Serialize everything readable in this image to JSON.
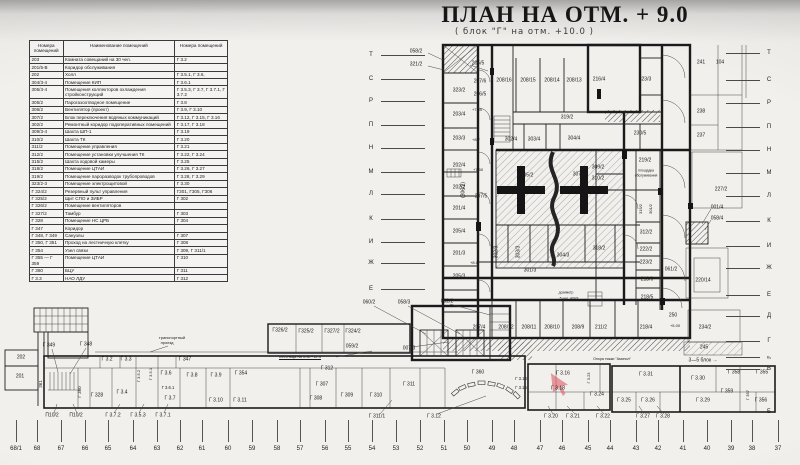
{
  "title": "ПЛАН НА ОТМ. + 9.0",
  "subtitle": "( блок \"Г\"  на  отм.  +10.0 )",
  "colors": {
    "ink": "#1c1c1c",
    "paper": "#f0efec",
    "highlight": "#e0565f"
  },
  "legend": {
    "headers": [
      "Номера помещений",
      "Наименование помещений",
      "Номера помещений"
    ],
    "rows": [
      [
        "203",
        "Комната совещаний на 30 чел.",
        "Г 3.2"
      ],
      [
        "201/5-В",
        "Коридор обслуживания",
        ""
      ],
      [
        "202",
        "Холл",
        "Г 3.5.1,  Г 3.6,"
      ],
      [
        "304/3-4",
        "Помещение КИП",
        "Г 3.6.1"
      ],
      [
        "305/3-4",
        "Помещения коллекторов охлаждения стройконструкций",
        "Г 3.5.3,  Г 3.7, Г 3.7.1,  Г 3.7.2"
      ],
      [
        "305/2",
        "Парогазоотводное помещение",
        "Г 3.8"
      ],
      [
        "306/2",
        "Вентилятор (проект)",
        "Г 3.9,  Г 3.10"
      ],
      [
        "307/2",
        "Блок переключения водяных коммуникаций",
        "Г 3.12,  Г 3.15, Г 3.16"
      ],
      [
        "302/2",
        "Ремонтный коридор подоперативных помещений",
        "Г 3.17, Г 3.18"
      ],
      [
        "309/3-4",
        "Шахта ШП-1",
        "Г 3.19"
      ],
      [
        "310/2",
        "Шахта ТК",
        "Г 3.20"
      ],
      [
        "311/2",
        "Помещение управления",
        "Г 3.21"
      ],
      [
        "312/2",
        "Помещение установки улучшения ТК",
        "Г 3.22, Г 3.24"
      ],
      [
        "315/2",
        "Шахта ходовой камеры",
        "Г 3.25"
      ],
      [
        "318/2",
        "Помещение ЦТАИ",
        "Г 3.26,  Г 3.27"
      ],
      [
        "319/2",
        "Помещение пароразводок трубопроводов",
        "Г 3.28, Г 3.29"
      ],
      [
        "323/2-3",
        "Помещение электрощитовой",
        "Г 3.30"
      ],
      [
        "Г 324/2",
        "Резервный пульт управления",
        "Г301, Г305, Г306"
      ],
      [
        "Г 325/2",
        "Щит СПО и ЗИБР",
        "Г 302"
      ],
      [
        "Г 326/2",
        "Помещение вентиляторов",
        ""
      ],
      [
        "Г 327/2",
        "Тамбур",
        "Г 303"
      ],
      [
        "Г 328",
        "Помещение НС ЦРБ",
        "Г 304"
      ],
      [
        "Г 347",
        "Коридор",
        ""
      ],
      [
        "Г 348, Г 349",
        "Санузлы",
        "Г 307"
      ],
      [
        "Г 350, Г 351",
        "Проход на лестничную клетку",
        "Г 308"
      ],
      [
        "Г 354",
        "Узел связи",
        "Г 309,  Г 311/1"
      ],
      [
        "Г 355 — Г 359",
        "Помещение ЦТАИ",
        "Г 310"
      ],
      [
        "Г 360",
        "БЦУ",
        "Г 311"
      ],
      [
        "Г 3.3",
        "НАО ЛДУ",
        "Г 312"
      ]
    ]
  },
  "plan": {
    "labels": [
      {
        "t": "058/2",
        "x": 416,
        "y": 52
      },
      {
        "t": "321/2",
        "x": 416,
        "y": 65
      },
      {
        "t": "323/2",
        "x": 459,
        "y": 91
      },
      {
        "t": "203/4",
        "x": 459,
        "y": 115
      },
      {
        "t": "203/3",
        "x": 459,
        "y": 139
      },
      {
        "t": "202/4",
        "x": 459,
        "y": 166
      },
      {
        "t": "202/2",
        "x": 459,
        "y": 188
      },
      {
        "t": "201/4",
        "x": 459,
        "y": 209
      },
      {
        "t": "205/4",
        "x": 459,
        "y": 232
      },
      {
        "t": "201/3",
        "x": 459,
        "y": 254
      },
      {
        "t": "205/3",
        "x": 459,
        "y": 277
      },
      {
        "t": "002/2",
        "x": 447,
        "y": 302
      },
      {
        "t": "(306/2)",
        "x": 464,
        "y": 190,
        "r": -90
      },
      {
        "t": "205/5",
        "x": 478,
        "y": 64
      },
      {
        "t": "207/6",
        "x": 480,
        "y": 82
      },
      {
        "t": "206/5",
        "x": 480,
        "y": 95
      },
      {
        "t": "+7.50",
        "x": 477,
        "y": 110,
        "fs": 4
      },
      {
        "t": "+8.7",
        "x": 476,
        "y": 140,
        "fs": 4
      },
      {
        "t": "+7.50",
        "x": 478,
        "y": 170,
        "fs": 4
      },
      {
        "t": "207/5",
        "x": 481,
        "y": 197
      },
      {
        "t": "+8.0",
        "x": 474,
        "y": 263,
        "fs": 4
      },
      {
        "t": "208/16",
        "x": 504,
        "y": 81
      },
      {
        "t": "208/15",
        "x": 528,
        "y": 81
      },
      {
        "t": "208/14",
        "x": 552,
        "y": 81
      },
      {
        "t": "208/13",
        "x": 574,
        "y": 81
      },
      {
        "t": "216/4",
        "x": 599,
        "y": 80
      },
      {
        "t": "323/3",
        "x": 645,
        "y": 80
      },
      {
        "t": "319/2",
        "x": 567,
        "y": 118
      },
      {
        "t": "302/4",
        "x": 511,
        "y": 140
      },
      {
        "t": "303/4",
        "x": 534,
        "y": 140
      },
      {
        "t": "304/4",
        "x": 574,
        "y": 139
      },
      {
        "t": "305/2",
        "x": 527,
        "y": 176
      },
      {
        "t": "307/2",
        "x": 579,
        "y": 175
      },
      {
        "t": "309/2",
        "x": 598,
        "y": 168
      },
      {
        "t": "310/2",
        "x": 598,
        "y": 179
      },
      {
        "t": "230/5",
        "x": 640,
        "y": 134
      },
      {
        "t": "219/2",
        "x": 645,
        "y": 161
      },
      {
        "t": "площадка",
        "x": 646,
        "y": 171,
        "fs": 3.4
      },
      {
        "t": "обслуживания",
        "x": 646,
        "y": 176,
        "fs": 3.4
      },
      {
        "t": "315/2",
        "x": 641,
        "y": 209,
        "r": -90,
        "fs": 4
      },
      {
        "t": "301/2",
        "x": 651,
        "y": 209,
        "r": -90,
        "fs": 4
      },
      {
        "t": "312/2",
        "x": 646,
        "y": 233
      },
      {
        "t": "222/2",
        "x": 646,
        "y": 250
      },
      {
        "t": "223/2",
        "x": 646,
        "y": 263
      },
      {
        "t": "218/6",
        "x": 647,
        "y": 280
      },
      {
        "t": "218/5",
        "x": 647,
        "y": 298
      },
      {
        "t": "061/2",
        "x": 671,
        "y": 270
      },
      {
        "t": "302/3",
        "x": 497,
        "y": 252,
        "r": -90
      },
      {
        "t": "303/3",
        "x": 519,
        "y": 252,
        "r": -90
      },
      {
        "t": "304/3",
        "x": 563,
        "y": 256
      },
      {
        "t": "318/2",
        "x": 599,
        "y": 249
      },
      {
        "t": "301/3",
        "x": 530,
        "y": 271
      },
      {
        "t": "дозиметр",
        "x": 566,
        "y": 293,
        "fs": 3.4
      },
      {
        "t": "5 чел. 403/3",
        "x": 569,
        "y": 299,
        "fs": 3.4
      },
      {
        "t": "207/4",
        "x": 479,
        "y": 328
      },
      {
        "t": "208/12",
        "x": 506,
        "y": 328
      },
      {
        "t": "208/11",
        "x": 529,
        "y": 328
      },
      {
        "t": "208/10",
        "x": 552,
        "y": 328
      },
      {
        "t": "208/9",
        "x": 578,
        "y": 328
      },
      {
        "t": "211/2",
        "x": 601,
        "y": 328
      },
      {
        "t": "218/4",
        "x": 646,
        "y": 328
      },
      {
        "t": "250",
        "x": 673,
        "y": 316
      },
      {
        "t": "+5.00",
        "x": 675,
        "y": 326,
        "fs": 4
      },
      {
        "t": "234/2",
        "x": 705,
        "y": 328
      },
      {
        "t": "241",
        "x": 701,
        "y": 63
      },
      {
        "t": "104",
        "x": 720,
        "y": 63
      },
      {
        "t": "238",
        "x": 701,
        "y": 112
      },
      {
        "t": "237",
        "x": 701,
        "y": 136
      },
      {
        "t": "227/2",
        "x": 721,
        "y": 190
      },
      {
        "t": "001/4",
        "x": 717,
        "y": 208
      },
      {
        "t": "058/4",
        "x": 717,
        "y": 219
      },
      {
        "t": "220/14",
        "x": 703,
        "y": 281
      },
      {
        "t": "245",
        "x": 704,
        "y": 348
      },
      {
        "t": "3—5 блок →",
        "x": 703,
        "y": 361
      },
      {
        "t": "Опора тяжки \"Аминол\"",
        "x": 612,
        "y": 360,
        "fs": 3.6
      },
      {
        "t": "202",
        "x": 21,
        "y": 358
      },
      {
        "t": "201",
        "x": 20,
        "y": 377
      },
      {
        "t": "361",
        "x": 41,
        "y": 384,
        "r": -90,
        "fs": 4.5
      },
      {
        "t": "Г 349",
        "x": 49,
        "y": 346
      },
      {
        "t": "Г 348",
        "x": 86,
        "y": 345
      },
      {
        "t": "Г 350",
        "x": 80,
        "y": 392,
        "r": -90,
        "fs": 4.5
      },
      {
        "t": "Г 328",
        "x": 97,
        "y": 396
      },
      {
        "t": "Г 3.4",
        "x": 122,
        "y": 393
      },
      {
        "t": "Г 3.2",
        "x": 107,
        "y": 360
      },
      {
        "t": "Г 3.3",
        "x": 126,
        "y": 360
      },
      {
        "t": "Г 3.5.2",
        "x": 139,
        "y": 376,
        "r": -90,
        "fs": 4
      },
      {
        "t": "Г 3.5.1",
        "x": 151,
        "y": 374,
        "r": -90,
        "fs": 4
      },
      {
        "t": "Г 3.6",
        "x": 166,
        "y": 374
      },
      {
        "t": "Г 3.6.1",
        "x": 168,
        "y": 388,
        "fs": 4.2
      },
      {
        "t": "Г 3.7",
        "x": 170,
        "y": 399
      },
      {
        "t": "Г 3.8",
        "x": 192,
        "y": 376
      },
      {
        "t": "Г 3.9",
        "x": 216,
        "y": 376
      },
      {
        "t": "Г 3.10",
        "x": 216,
        "y": 401
      },
      {
        "t": "Г 354",
        "x": 241,
        "y": 374
      },
      {
        "t": "Г 3.11",
        "x": 240,
        "y": 401
      },
      {
        "t": "Г 347",
        "x": 185,
        "y": 360
      },
      {
        "t": "транспортный",
        "x": 172,
        "y": 338,
        "fs": 4
      },
      {
        "t": "проезд",
        "x": 167,
        "y": 343,
        "fs": 4
      },
      {
        "t": "П10/2",
        "x": 52,
        "y": 416
      },
      {
        "t": "П10/2",
        "x": 76,
        "y": 416
      },
      {
        "t": "Г 3.7.2",
        "x": 113,
        "y": 416
      },
      {
        "t": "Г 3.5.3",
        "x": 138,
        "y": 416
      },
      {
        "t": "Г 3.7.1",
        "x": 163,
        "y": 416
      },
      {
        "t": "Г326/2",
        "x": 280,
        "y": 331
      },
      {
        "t": "Г325/2",
        "x": 306,
        "y": 332
      },
      {
        "t": "Г327/2",
        "x": 332,
        "y": 332
      },
      {
        "t": "Г324/2",
        "x": 353,
        "y": 332
      },
      {
        "t": "059/2",
        "x": 352,
        "y": 347
      },
      {
        "t": "060/2",
        "x": 369,
        "y": 303
      },
      {
        "t": "058/3",
        "x": 404,
        "y": 303
      },
      {
        "t": "007/3",
        "x": 409,
        "y": 349
      },
      {
        "t": "лестница на отм.+12.5",
        "x": 300,
        "y": 357,
        "fs": 4,
        "u": 1
      },
      {
        "t": "Г 312",
        "x": 327,
        "y": 369
      },
      {
        "t": "Г 307",
        "x": 322,
        "y": 385
      },
      {
        "t": "Г 308",
        "x": 316,
        "y": 399
      },
      {
        "t": "Г 309",
        "x": 347,
        "y": 396
      },
      {
        "t": "Г 310",
        "x": 376,
        "y": 396
      },
      {
        "t": "Г 311",
        "x": 409,
        "y": 385
      },
      {
        "t": "Г 311/1",
        "x": 377,
        "y": 417
      },
      {
        "t": "Г 3.12",
        "x": 434,
        "y": 417
      },
      {
        "t": "Г 360",
        "x": 478,
        "y": 373
      },
      {
        "t": "Г 3.14",
        "x": 521,
        "y": 379,
        "fs": 4.2
      },
      {
        "t": "Г 3.15",
        "x": 521,
        "y": 388,
        "fs": 4.2
      },
      {
        "t": "Г 3.16",
        "x": 563,
        "y": 374
      },
      {
        "t": "Г 3.18",
        "x": 558,
        "y": 389
      },
      {
        "t": "Г 3.23",
        "x": 589,
        "y": 378,
        "r": -90,
        "fs": 4
      },
      {
        "t": "Г 3.24",
        "x": 597,
        "y": 395
      },
      {
        "t": "Г 3.20",
        "x": 551,
        "y": 417
      },
      {
        "t": "Г 3.21",
        "x": 573,
        "y": 417
      },
      {
        "t": "Г 3.22",
        "x": 603,
        "y": 417
      },
      {
        "t": "Г 3.31",
        "x": 646,
        "y": 375
      },
      {
        "t": "Г 3.25",
        "x": 624,
        "y": 401
      },
      {
        "t": "Г 3.26",
        "x": 648,
        "y": 401
      },
      {
        "t": "Г 3.27",
        "x": 643,
        "y": 417
      },
      {
        "t": "Г 3.28",
        "x": 663,
        "y": 417
      },
      {
        "t": "Г 3.30",
        "x": 698,
        "y": 379
      },
      {
        "t": "Г 3.29",
        "x": 703,
        "y": 401
      },
      {
        "t": "Г 358",
        "x": 734,
        "y": 373
      },
      {
        "t": "Г 355",
        "x": 762,
        "y": 373
      },
      {
        "t": "Г 359",
        "x": 727,
        "y": 392
      },
      {
        "t": "Г 357",
        "x": 748,
        "y": 395,
        "r": -90,
        "fs": 4
      },
      {
        "t": "Г 356",
        "x": 761,
        "y": 401
      }
    ],
    "grid_left": [
      {
        "l": "Т",
        "y": 55
      },
      {
        "l": "С",
        "y": 79
      },
      {
        "l": "Р",
        "y": 101
      },
      {
        "l": "П",
        "y": 125
      },
      {
        "l": "Н",
        "y": 148
      },
      {
        "l": "М",
        "y": 172
      },
      {
        "l": "Л",
        "y": 194
      },
      {
        "l": "К",
        "y": 219
      },
      {
        "l": "И",
        "y": 242
      },
      {
        "l": "Ж",
        "y": 263
      },
      {
        "l": "Е",
        "y": 289
      }
    ],
    "grid_right": [
      {
        "l": "Т",
        "y": 53
      },
      {
        "l": "С",
        "y": 80
      },
      {
        "l": "Р",
        "y": 103
      },
      {
        "l": "П",
        "y": 127
      },
      {
        "l": "Н",
        "y": 150
      },
      {
        "l": "М",
        "y": 173
      },
      {
        "l": "Л",
        "y": 196
      },
      {
        "l": "К",
        "y": 221
      },
      {
        "l": "И",
        "y": 246
      },
      {
        "l": "Ж",
        "y": 268
      },
      {
        "l": "Е",
        "y": 295
      },
      {
        "l": "Д",
        "y": 316
      },
      {
        "l": "Г",
        "y": 341
      },
      {
        "l": "В₁",
        "y": 357,
        "fs": 4
      },
      {
        "l": "В",
        "y": 369
      },
      {
        "l": "Б",
        "y": 412
      }
    ],
    "axes": [
      {
        "t": "68/1",
        "x": 16
      },
      {
        "t": "68",
        "x": 37
      },
      {
        "t": "67",
        "x": 61
      },
      {
        "t": "66",
        "x": 85
      },
      {
        "t": "65",
        "x": 108
      },
      {
        "t": "64",
        "x": 133
      },
      {
        "t": "63",
        "x": 157
      },
      {
        "t": "62",
        "x": 180
      },
      {
        "t": "61",
        "x": 202
      },
      {
        "t": "60",
        "x": 228
      },
      {
        "t": "59",
        "x": 252
      },
      {
        "t": "58",
        "x": 277
      },
      {
        "t": "57",
        "x": 300
      },
      {
        "t": "56",
        "x": 325
      },
      {
        "t": "55",
        "x": 348
      },
      {
        "t": "54",
        "x": 372
      },
      {
        "t": "53",
        "x": 396
      },
      {
        "t": "52",
        "x": 420
      },
      {
        "t": "51",
        "x": 444
      },
      {
        "t": "50",
        "x": 467
      },
      {
        "t": "49",
        "x": 492
      },
      {
        "t": "48",
        "x": 514
      },
      {
        "t": "47",
        "x": 540
      },
      {
        "t": "46",
        "x": 562
      },
      {
        "t": "45",
        "x": 588
      },
      {
        "t": "44",
        "x": 610
      },
      {
        "t": "43",
        "x": 636
      },
      {
        "t": "42",
        "x": 658
      },
      {
        "t": "41",
        "x": 683
      },
      {
        "t": "40",
        "x": 707
      },
      {
        "t": "39",
        "x": 731
      },
      {
        "t": "38",
        "x": 752
      },
      {
        "t": "37",
        "x": 778
      }
    ]
  }
}
